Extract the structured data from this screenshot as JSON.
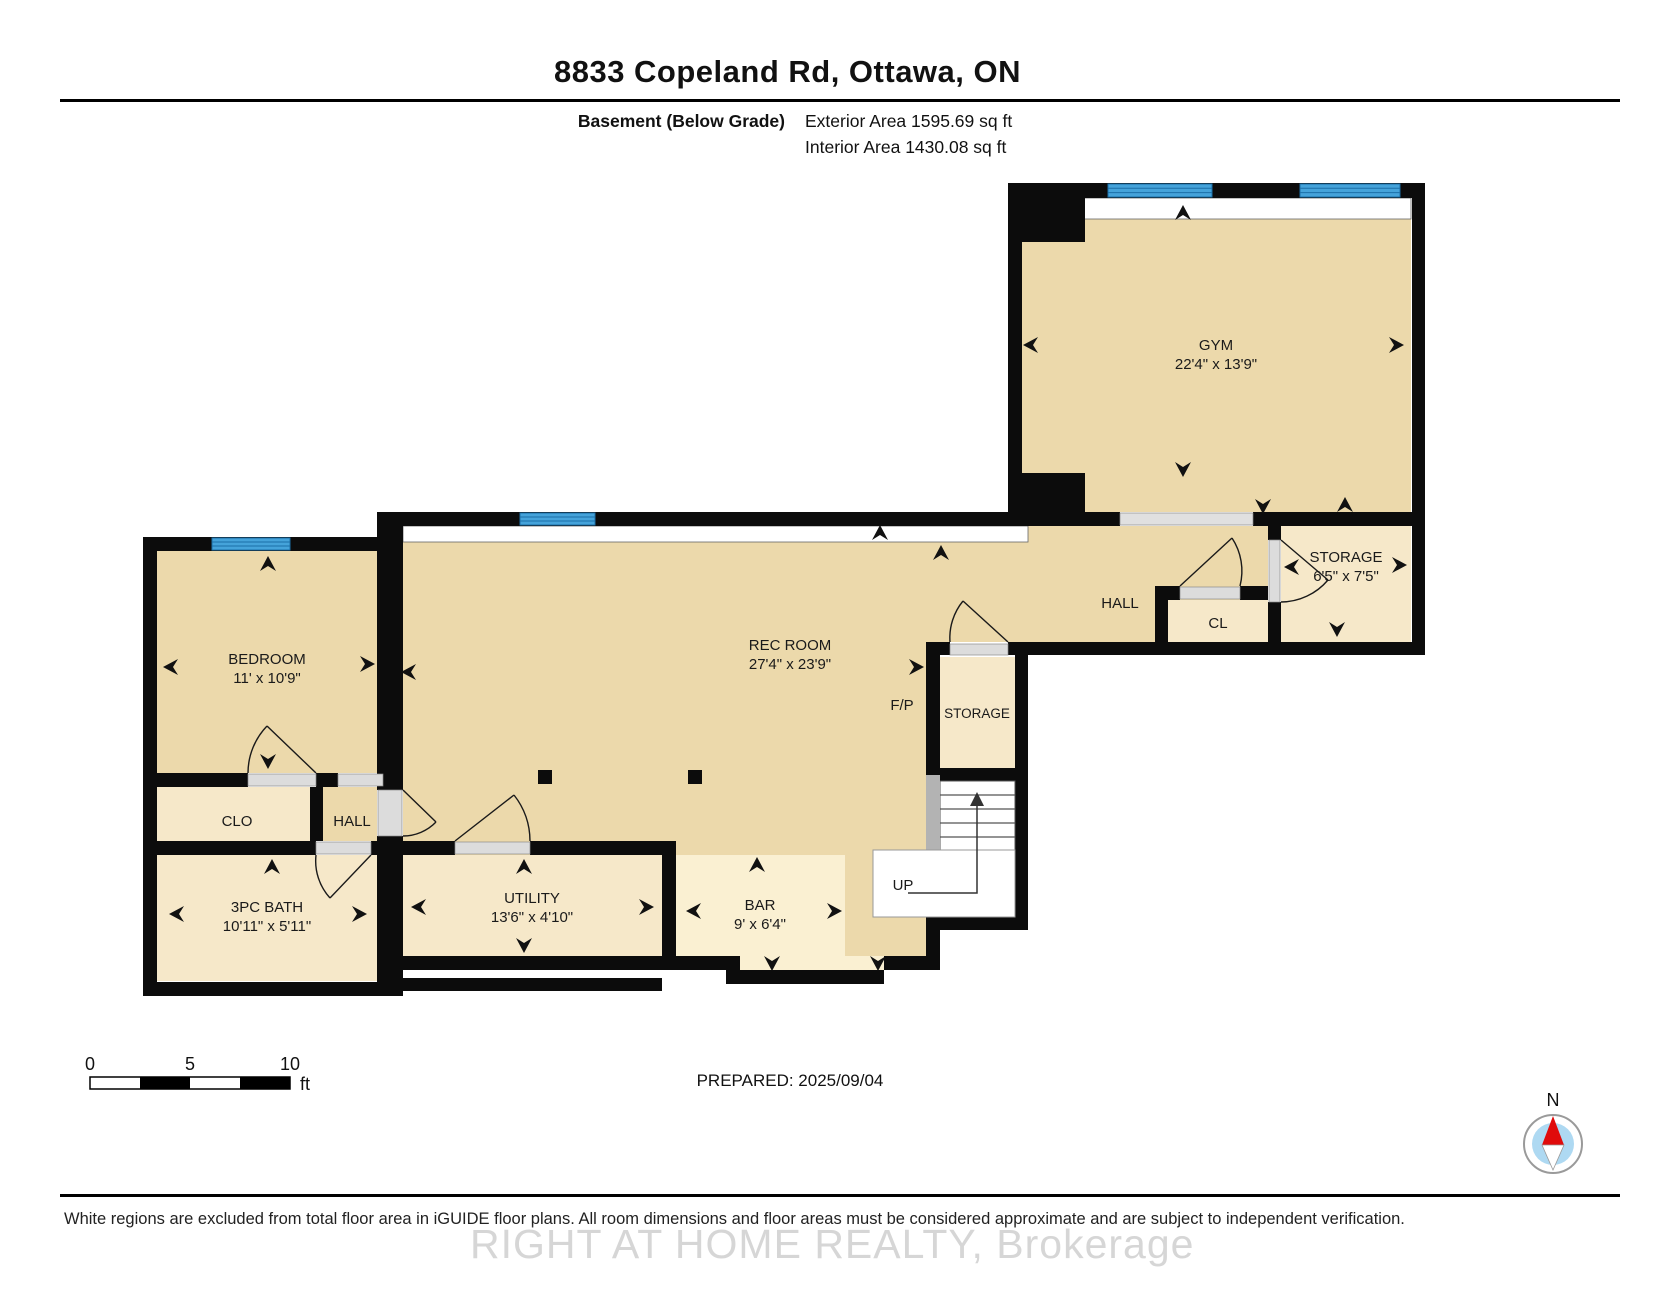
{
  "header": {
    "title": "8833 Copeland Rd, Ottawa, ON",
    "floor_label": "Basement (Below Grade)",
    "exterior_area": "Exterior Area 1595.69 sq ft",
    "interior_area": "Interior Area 1430.08 sq ft"
  },
  "rooms": {
    "gym": {
      "name": "GYM",
      "dims": "22'4\" x 13'9\""
    },
    "hall_right": {
      "name": "HALL"
    },
    "storage_right": {
      "name": "STORAGE",
      "dims": "6'5\" x 7'5\""
    },
    "cl": {
      "name": "CL"
    },
    "rec": {
      "name": "REC ROOM",
      "dims": "27'4\" x 23'9\""
    },
    "fireplace": {
      "name": "F/P"
    },
    "storage_small": {
      "name": "STORAGE"
    },
    "stairs": {
      "name": "UP"
    },
    "bedroom": {
      "name": "BEDROOM",
      "dims": "11' x 10'9\""
    },
    "closet": {
      "name": "CLO"
    },
    "hall_left": {
      "name": "HALL"
    },
    "bath": {
      "name": "3PC BATH",
      "dims": "10'11\" x 5'11\""
    },
    "utility": {
      "name": "UTILITY",
      "dims": "13'6\" x 4'10\""
    },
    "bar": {
      "name": "BAR",
      "dims": "9' x 6'4\""
    }
  },
  "scale_bar": {
    "tick_0": "0",
    "tick_5": "5",
    "tick_10": "10",
    "unit": "ft"
  },
  "compass": {
    "label": "N"
  },
  "footer": {
    "prepared": "PREPARED: 2025/09/04",
    "disclaimer": "White regions are excluded from total floor area in iGUIDE floor plans. All room dimensions and floor areas must be considered approximate and are subject to independent verification.",
    "watermark": "RIGHT AT HOME REALTY, Brokerage"
  },
  "colors": {
    "wall": "#0c0c0c",
    "room_tan": "#ecd9ab",
    "room_cream": "#f6e8c9",
    "room_bar": "#faf0d2",
    "window_blue": "#45a3da",
    "window_stripe": "#1c6fa8",
    "door_sill": "#dcdcdc",
    "opening_gray": "#e0e0e0",
    "stair_rail": "#b3b3b3",
    "compass_blue": "#aed9f2",
    "compass_red": "#e00b0b",
    "watermark_gray": "#c9c9c9"
  }
}
